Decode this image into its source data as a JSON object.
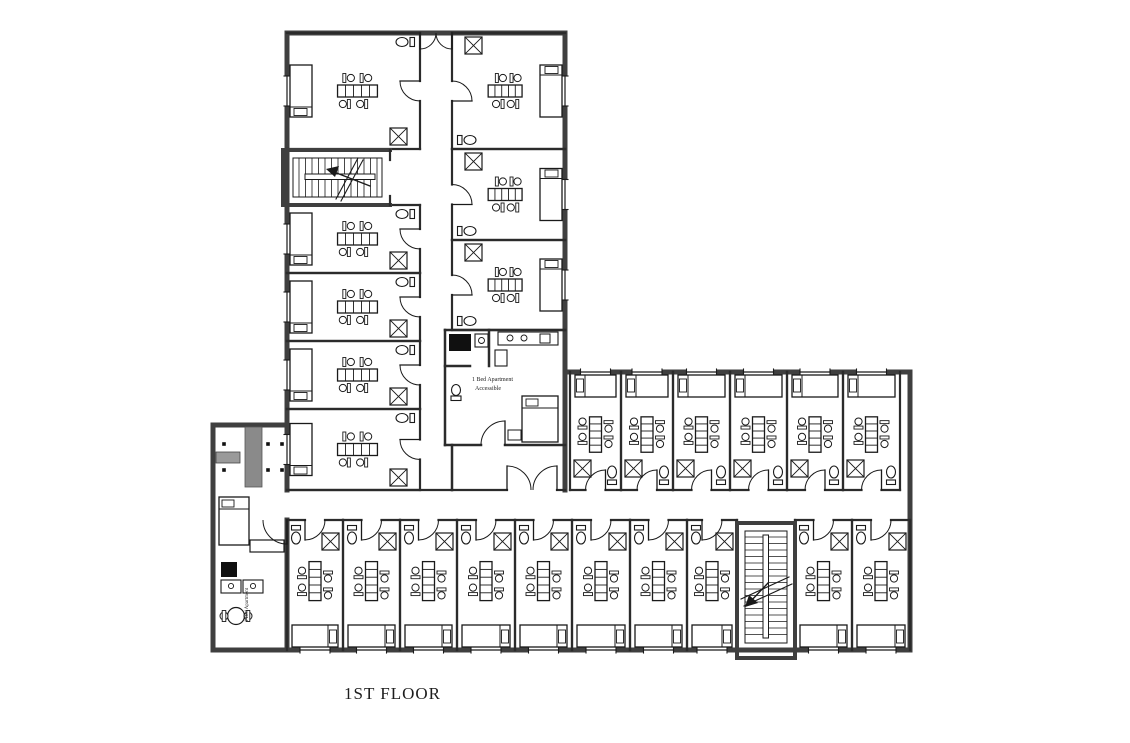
{
  "page": {
    "background_color": "#ffffff"
  },
  "floor_plan": {
    "title": "1ST FLOOR",
    "labels": {
      "accessible_apartment_line1": "1 Bed Apartment",
      "accessible_apartment_line2": "Accessible",
      "one_bed_apartment_vertical": "1 Bed Apartment"
    },
    "colors": {
      "wall": "#3f3f3f",
      "partition": "#2b2b2b",
      "furniture_line": "#1a1a1a",
      "label_text": "#1c1c1c",
      "elevator_gray": "#8a8a8a",
      "counter_gray": "#9a9a9a",
      "appliance_dark": "#101010",
      "background": "#ffffff"
    },
    "spaces": {
      "north_wing_rooms_left_column": 5,
      "north_wing_rooms_right_column": 3,
      "east_wing_rooms_top_row": 6,
      "east_wing_rooms_bottom_row": 10,
      "staircases": 2,
      "one_bed_apartments": 2,
      "entrance_lobby": 1
    }
  }
}
